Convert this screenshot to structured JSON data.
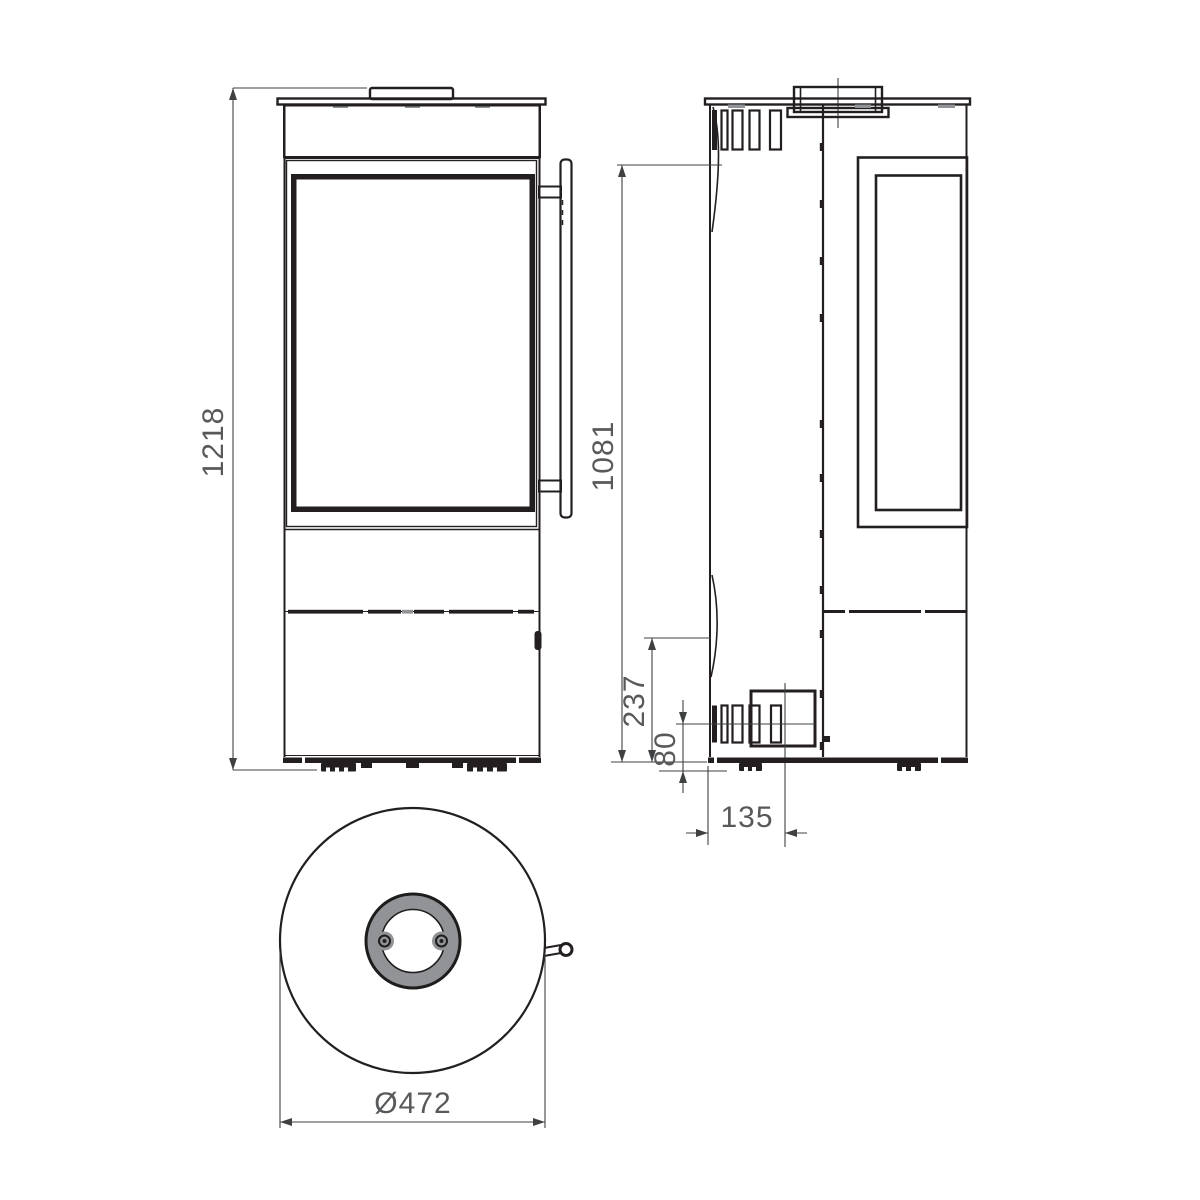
{
  "drawing": {
    "views": {
      "front_view": "front elevation of round stove",
      "side_view": "side elevation of round stove",
      "top_view": "plan view of round stove"
    },
    "dimensions": {
      "overall_height": "1218",
      "rear_height": "1081",
      "lower_height": "237",
      "base_height": "80",
      "rear_offset": "135",
      "diameter": "Ø472"
    },
    "colors": {
      "line": "#231f20",
      "dimension_line": "#3f4042",
      "label_text": "#58595b",
      "flue_ring_fill": "#919396",
      "background": "#ffffff"
    }
  }
}
